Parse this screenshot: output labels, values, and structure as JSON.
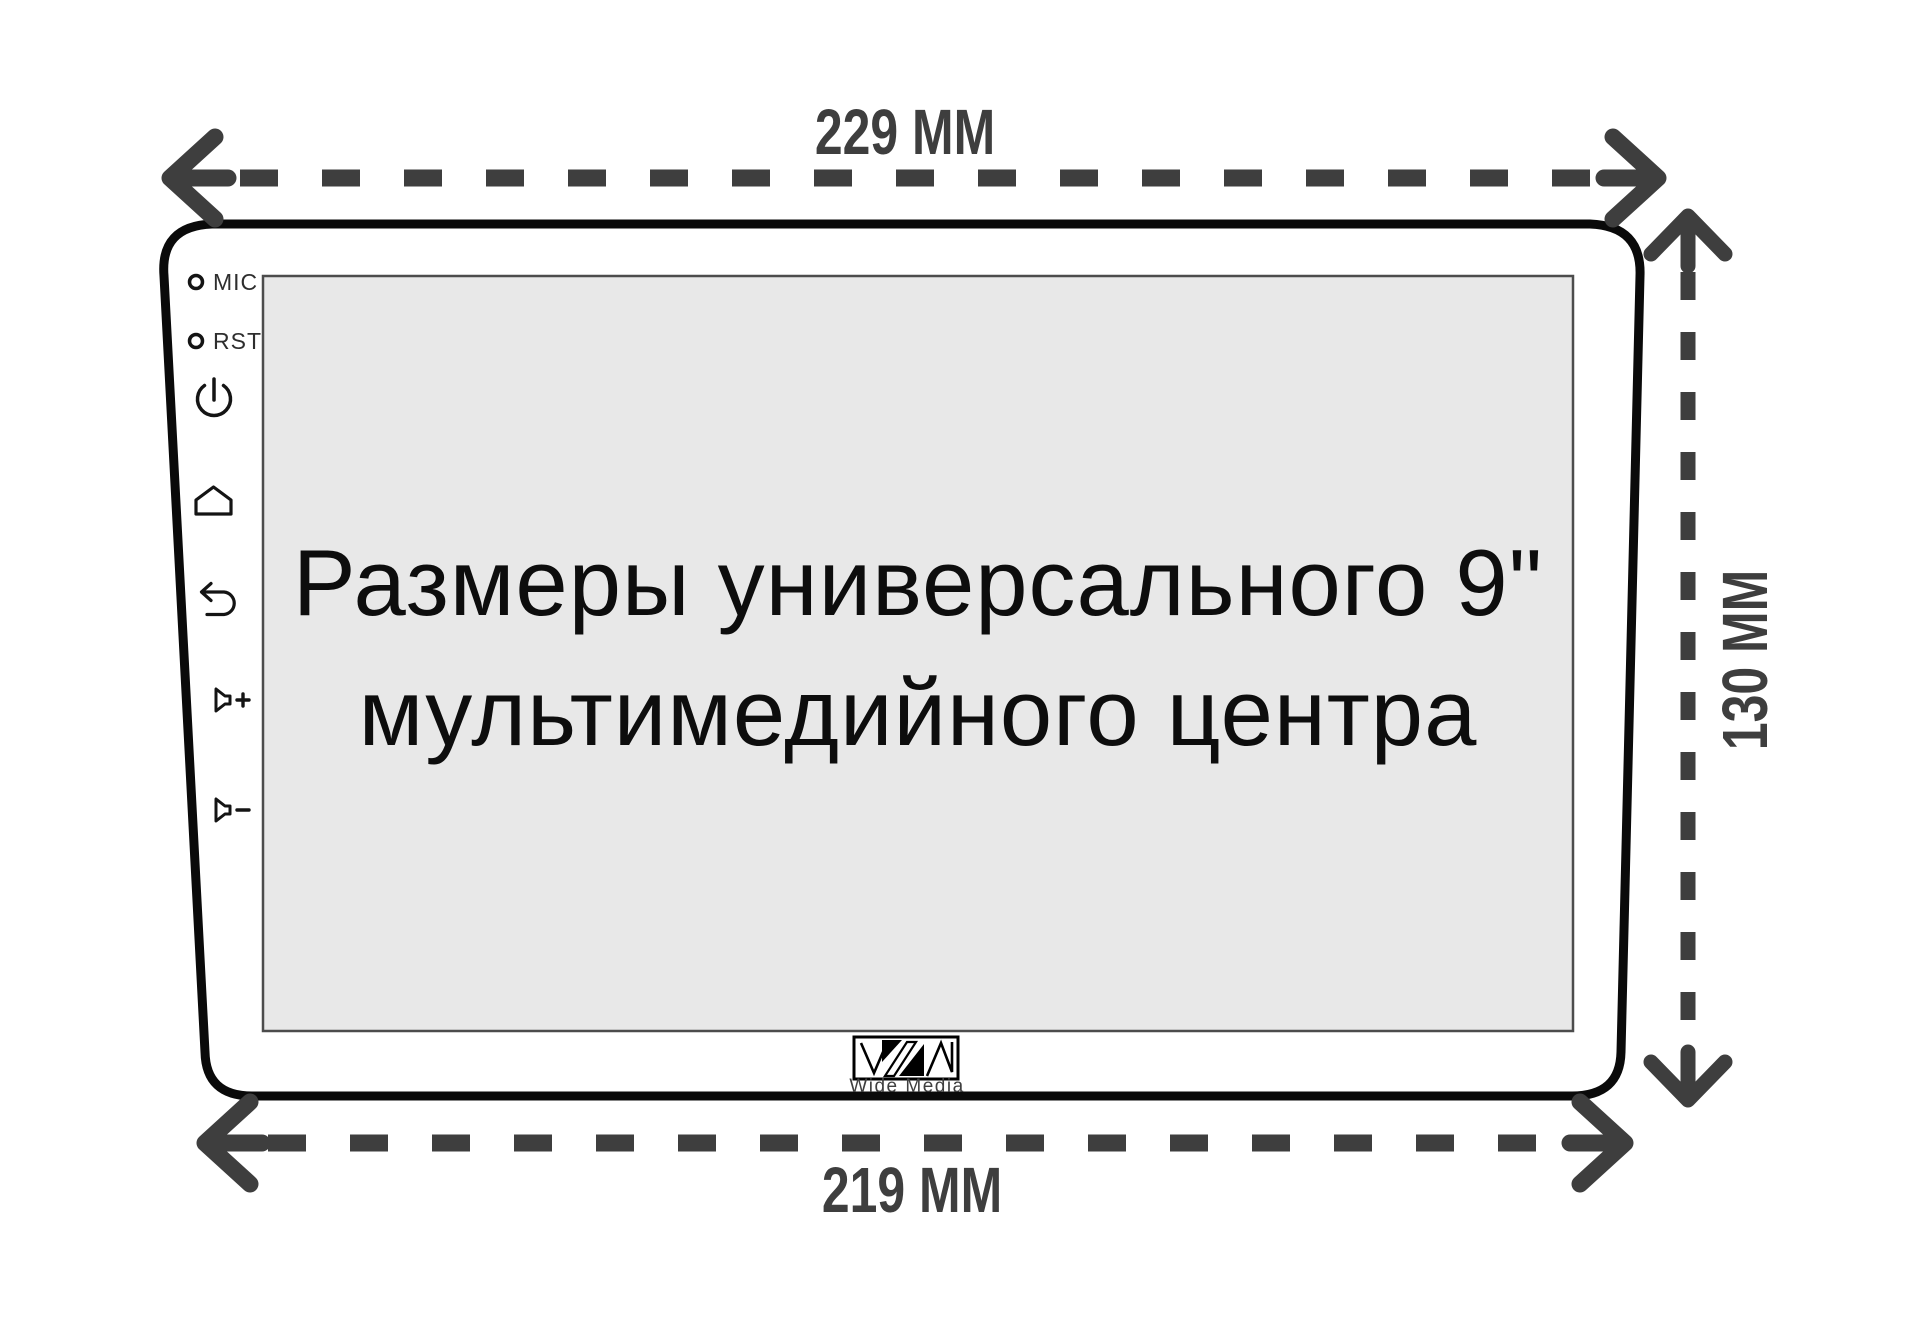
{
  "diagram": {
    "type": "product-dimensions-diagram",
    "dimensions": {
      "top_width": "229 ММ",
      "bottom_width": "219 ММ",
      "right_height": "130 ММ"
    },
    "device": {
      "side_controls": {
        "mic_label": "MIC",
        "rst_label": "RST",
        "buttons": [
          "power-icon",
          "home-icon",
          "back-icon",
          "volume-up-icon",
          "volume-down-icon"
        ]
      },
      "screen": {
        "caption_line1": "Размеры универсального 9\"",
        "caption_line2": "мультимедийного центра"
      },
      "brand": {
        "logo": "wide-media-monogram",
        "name": "Wide Media"
      }
    },
    "colors": {
      "arrow": "#3e3e3e",
      "outline": "#0a0a0a",
      "screen_fill": "#e8e8e8",
      "screen_border": "#4c4c4c",
      "background": "#ffffff",
      "caption_text": "#0d0d0d"
    }
  }
}
